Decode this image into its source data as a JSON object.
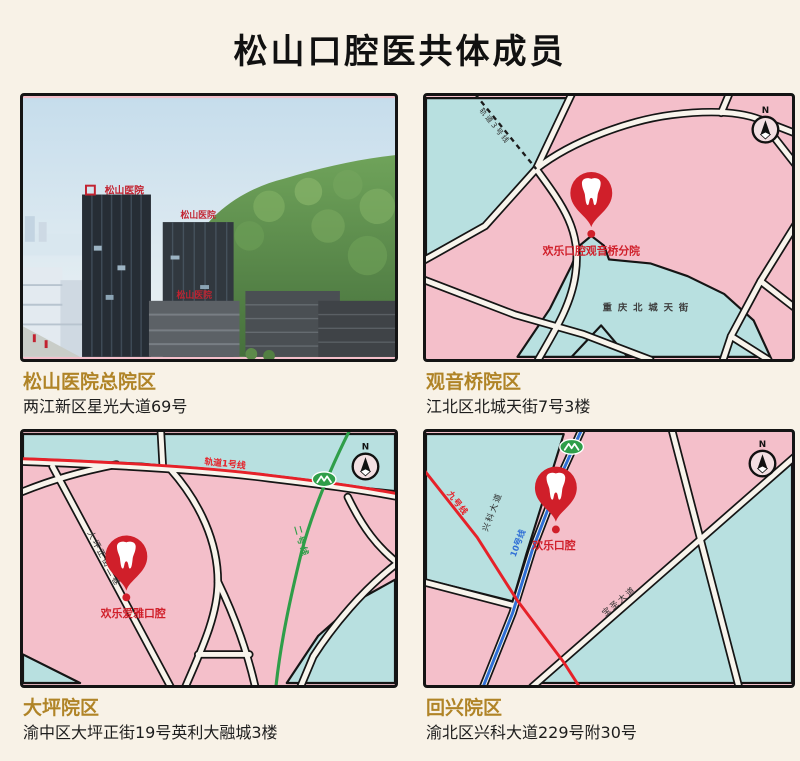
{
  "title": "松山口腔医共体成员",
  "colors": {
    "background": "#f8f2e7",
    "map_pink": "#f4bfca",
    "map_cyan": "#b8e0e0",
    "road_fill": "#f8f4ec",
    "outline": "#151515",
    "pin_red": "#d01f2a",
    "caption_gold": "#b08427",
    "metro_red": "#e62129",
    "metro_green": "#2f9e49",
    "metro_blue": "#2f6fd6"
  },
  "panels": {
    "main": {
      "name": "松山医院总院区",
      "address": "两江新区星光大道69号",
      "photo_sign": "松山医院"
    },
    "guanyinqiao": {
      "name": "观音桥院区",
      "address": "江北区北城天街7号3楼",
      "pin_label": "欢乐口腔观音桥分院",
      "area_label": "重庆北城天街",
      "metro_label": "轨道3号线",
      "compass": "N"
    },
    "daping": {
      "name": "大坪院区",
      "address": "渝中区大坪正街19号英利大融城3楼",
      "pin_label": "欢乐爱雅口腔",
      "street_label": "大坪正街二巷",
      "metro_red_label": "轨道1号线",
      "metro_green_label": "二号线",
      "compass": "N"
    },
    "huixing": {
      "name": "回兴院区",
      "address": "渝北区兴科大道229号附30号",
      "pin_label": "欢乐口腔",
      "road_label": "兴科大道",
      "road2_label": "宝圣大道",
      "metro_blue_label": "10号线",
      "metro_red_label": "九号线",
      "compass": "N"
    }
  }
}
